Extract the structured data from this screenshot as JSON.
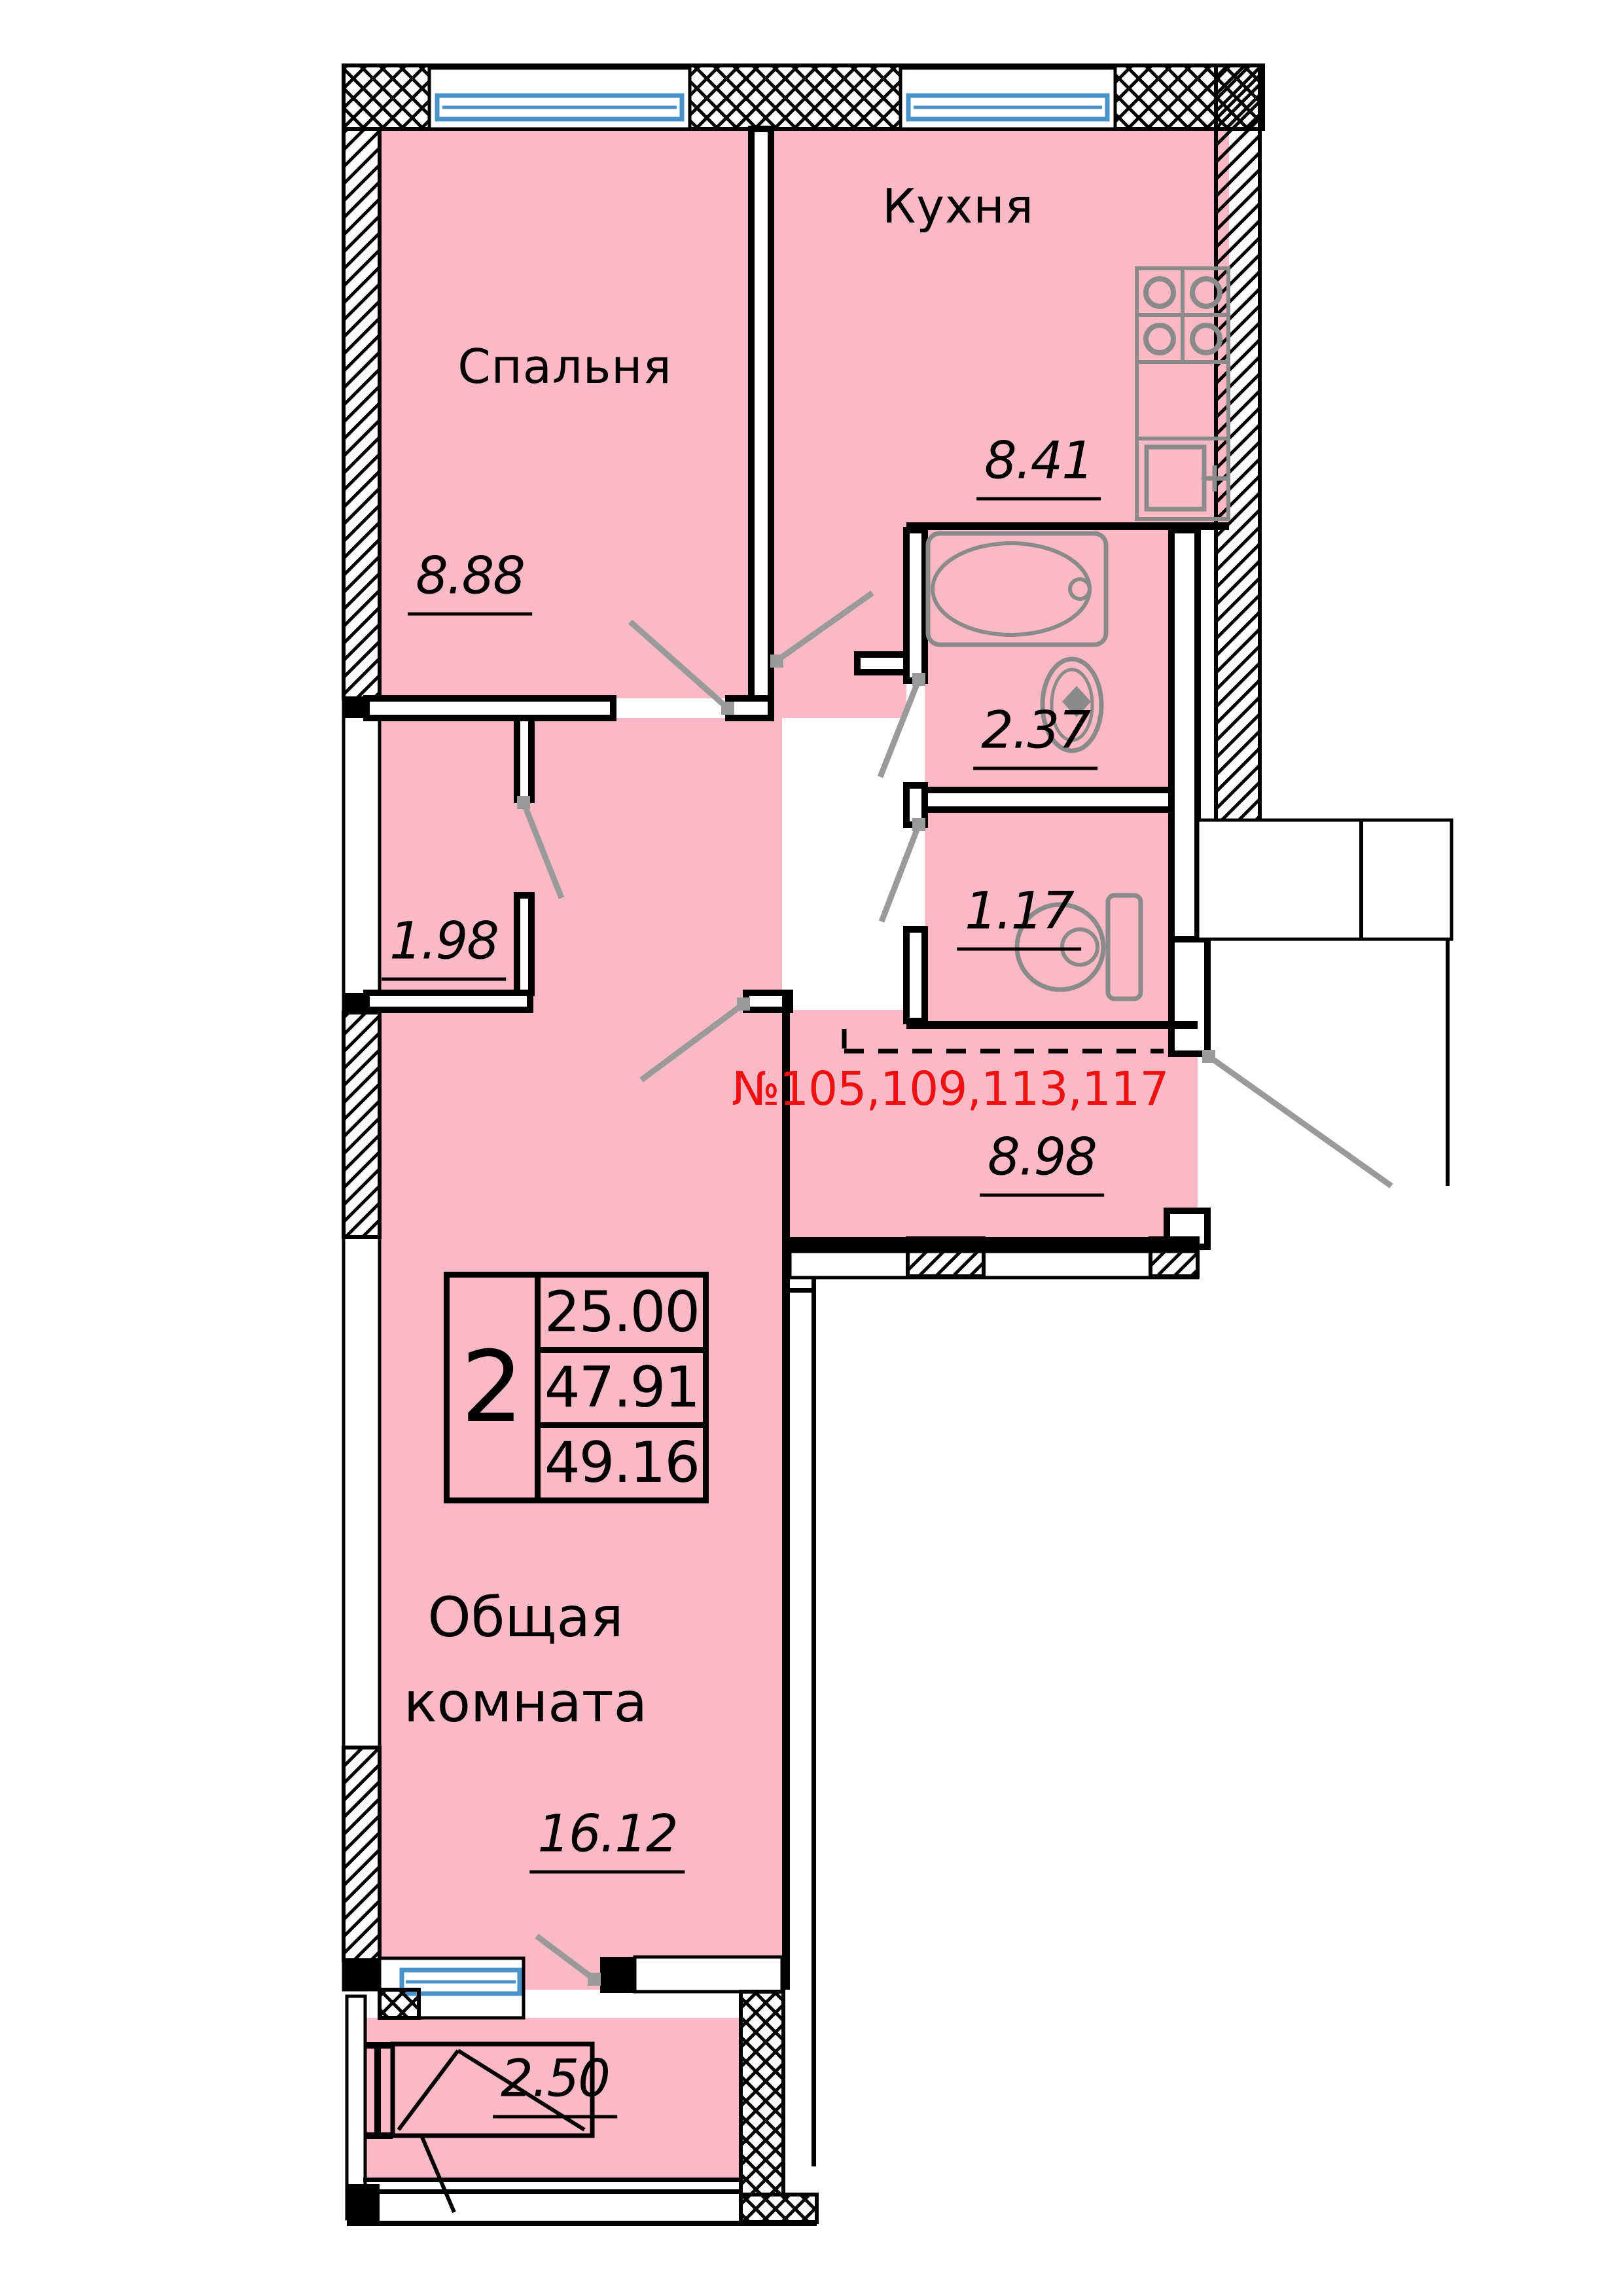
{
  "plan_title": "2-room apartment floor plan",
  "colors": {
    "room_fill": "#F9B9C6",
    "wall": "#000000",
    "window_blue": "#4893C9",
    "fixture_gray": "#8A8A8A",
    "door_gray": "#9A9A9A",
    "unit_red": "#EE1111"
  },
  "rooms": {
    "bedroom": {
      "label": "Спальня",
      "area": "8.88"
    },
    "kitchen": {
      "label": "Кухня",
      "area": "8.41"
    },
    "bathroom": {
      "area": "2.37"
    },
    "toilet": {
      "area": "1.17"
    },
    "closet": {
      "area": "1.98"
    },
    "hall": {
      "area": "8.98"
    },
    "living": {
      "label": "Общая комната",
      "area": "16.12"
    },
    "balcony": {
      "area": "2.50"
    }
  },
  "unit_numbers": "№105,109,113,117",
  "info_box": {
    "rooms_count": "2",
    "living_area": "25.00",
    "apartment_area": "47.91",
    "total_area": "49.16"
  }
}
